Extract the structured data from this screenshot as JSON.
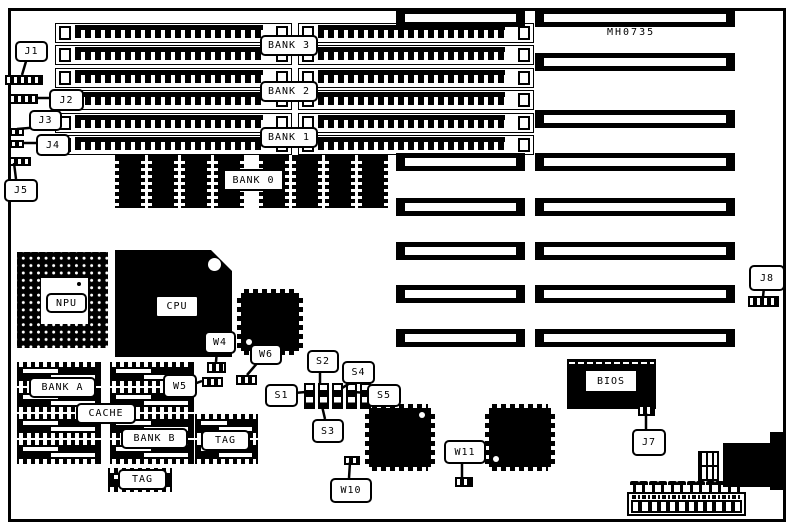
{
  "board": {
    "part_number": "MH0735",
    "ink_color": "#000000",
    "paper_color": "#ffffff"
  },
  "memory": {
    "simm_row_count": 6,
    "simm_banks": {
      "bank3": "BANK 3",
      "bank2": "BANK 2",
      "bank1": "BANK 1"
    },
    "bank0": {
      "label": "BANK 0",
      "chip_count": 8
    }
  },
  "processors": {
    "npu": "NPU",
    "cpu": "CPU"
  },
  "cache": {
    "bank_a": "BANK A",
    "bank_b": "BANK B",
    "cache": "CACHE",
    "tag_right": "TAG",
    "tag_bottom": "TAG",
    "chips_per_bank": 4,
    "tag_right_chip_count": 2
  },
  "firmware": {
    "bios": "BIOS"
  },
  "connectors": {
    "j1": "J1",
    "j2": "J2",
    "j3": "J3",
    "j4": "J4",
    "j5": "J5",
    "j7": "J7",
    "j8": "J8"
  },
  "jumpers": {
    "w4": "W4",
    "w5": "W5",
    "w6": "W6",
    "w10": "W10",
    "w11": "W11"
  },
  "switches": {
    "s1": "S1",
    "s2": "S2",
    "s3": "S3",
    "s4": "S4",
    "s5": "S5",
    "count": 5
  },
  "expansion_slots": {
    "left_column_count": 6,
    "right_column_count": 8
  },
  "power_connector": {
    "pin_count": 12
  }
}
